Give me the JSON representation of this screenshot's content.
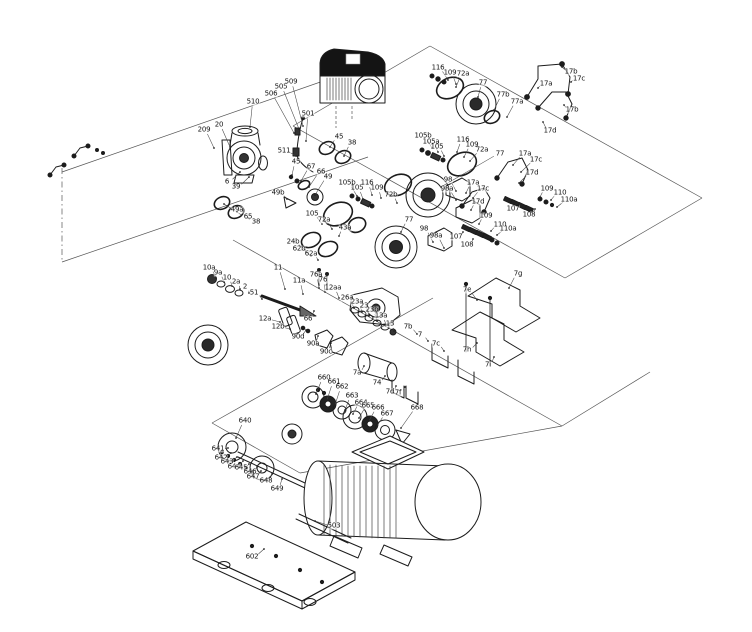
{
  "diagram": {
    "figure_type": "exploded-parts-diagram",
    "subject": "multistage pump with drive, shaft seals, coupling, guards, motor and base plate",
    "background_color": "#ffffff",
    "line_color": "#1c1c1c",
    "guide_line_color": "#555555",
    "label_color": "#111111"
  },
  "parts": [
    {
      "t": "209",
      "x": 204,
      "y": 130,
      "tx": 214,
      "ty": 148
    },
    {
      "t": "20",
      "x": 219,
      "y": 125,
      "tx": 230,
      "ty": 147
    },
    {
      "t": "510",
      "x": 253,
      "y": 102,
      "tx": 250,
      "ty": 127
    },
    {
      "t": "506",
      "x": 271,
      "y": 94,
      "tx": 294,
      "ty": 133
    },
    {
      "t": "505",
      "x": 281,
      "y": 87,
      "tx": 299,
      "ty": 129
    },
    {
      "t": "509",
      "x": 291,
      "y": 82,
      "tx": 303,
      "ty": 126
    },
    {
      "t": "501",
      "x": 308,
      "y": 114,
      "tx": 306,
      "ty": 141
    },
    {
      "t": "511",
      "x": 284,
      "y": 151,
      "tx": 296,
      "ty": 156
    },
    {
      "t": "6",
      "x": 227,
      "y": 182,
      "tx": 240,
      "ty": 172
    },
    {
      "t": "39",
      "x": 236,
      "y": 187,
      "tx": 249,
      "ty": 177
    },
    {
      "t": "49a",
      "x": 237,
      "y": 210,
      "tx": 224,
      "ty": 204
    },
    {
      "t": "65",
      "x": 248,
      "y": 217,
      "tx": 237,
      "ty": 212
    },
    {
      "t": "38",
      "x": 256,
      "y": 222,
      "tx": 248,
      "ty": 218
    },
    {
      "t": "45",
      "x": 296,
      "y": 162,
      "tx": 292,
      "ty": 175
    },
    {
      "t": "67",
      "x": 311,
      "y": 167,
      "tx": 301,
      "ty": 181
    },
    {
      "t": "66",
      "x": 321,
      "y": 172,
      "tx": 309,
      "ty": 187
    },
    {
      "t": "49",
      "x": 328,
      "y": 177,
      "tx": 315,
      "ty": 195
    },
    {
      "t": "49b",
      "x": 278,
      "y": 193,
      "tx": 287,
      "ty": 199
    },
    {
      "t": "45",
      "x": 339,
      "y": 137,
      "tx": 330,
      "ty": 147
    },
    {
      "t": "38",
      "x": 352,
      "y": 143,
      "tx": 344,
      "ty": 156
    },
    {
      "t": "105b",
      "x": 347,
      "y": 183,
      "tx": 357,
      "ty": 196
    },
    {
      "t": "105",
      "x": 357,
      "y": 188,
      "tx": 363,
      "ty": 199
    },
    {
      "t": "116",
      "x": 367,
      "y": 183,
      "tx": 372,
      "ty": 195
    },
    {
      "t": "109",
      "x": 377,
      "y": 188,
      "tx": 381,
      "ty": 198
    },
    {
      "t": "72b",
      "x": 391,
      "y": 195,
      "tx": 397,
      "ty": 203
    },
    {
      "t": "77",
      "x": 409,
      "y": 220,
      "tx": 401,
      "ty": 232
    },
    {
      "t": "98",
      "x": 424,
      "y": 229,
      "tx": 433,
      "ty": 242
    },
    {
      "t": "98a",
      "x": 436,
      "y": 236,
      "tx": 444,
      "ty": 248
    },
    {
      "t": "105",
      "x": 312,
      "y": 214,
      "tx": 322,
      "ty": 224
    },
    {
      "t": "72a",
      "x": 324,
      "y": 220,
      "tx": 332,
      "ty": 229
    },
    {
      "t": "43a",
      "x": 345,
      "y": 228,
      "tx": 339,
      "ty": 236
    },
    {
      "t": "24b",
      "x": 293,
      "y": 242,
      "tx": 305,
      "ty": 250
    },
    {
      "t": "62b",
      "x": 299,
      "y": 249,
      "tx": 311,
      "ty": 256
    },
    {
      "t": "62a",
      "x": 311,
      "y": 254,
      "tx": 318,
      "ty": 260
    },
    {
      "t": "10a",
      "x": 209,
      "y": 268,
      "tx": 216,
      "ty": 278
    },
    {
      "t": "9a",
      "x": 218,
      "y": 273,
      "tx": 224,
      "ty": 282
    },
    {
      "t": "10",
      "x": 227,
      "y": 278,
      "tx": 232,
      "ty": 286
    },
    {
      "t": "2a",
      "x": 236,
      "y": 282,
      "tx": 240,
      "ty": 289
    },
    {
      "t": "2",
      "x": 245,
      "y": 287,
      "tx": 249,
      "ty": 293
    },
    {
      "t": "51",
      "x": 254,
      "y": 293,
      "tx": 262,
      "ty": 299
    },
    {
      "t": "11",
      "x": 278,
      "y": 268,
      "tx": 285,
      "ty": 289
    },
    {
      "t": "11a",
      "x": 299,
      "y": 281,
      "tx": 303,
      "ty": 294
    },
    {
      "t": "76a",
      "x": 316,
      "y": 275,
      "tx": 319,
      "ty": 288
    },
    {
      "t": "76",
      "x": 323,
      "y": 280,
      "tx": 325,
      "ty": 292
    },
    {
      "t": "12aa",
      "x": 333,
      "y": 288,
      "tx": 339,
      "ty": 298
    },
    {
      "t": "66",
      "x": 308,
      "y": 319,
      "tx": 314,
      "ty": 311
    },
    {
      "t": "12a",
      "x": 265,
      "y": 319,
      "tx": 280,
      "ty": 322
    },
    {
      "t": "12b",
      "x": 278,
      "y": 327,
      "tx": 290,
      "ty": 329
    },
    {
      "t": "26a",
      "x": 347,
      "y": 298,
      "tx": 354,
      "ty": 308
    },
    {
      "t": "23a",
      "x": 357,
      "y": 302,
      "tx": 362,
      "ty": 312
    },
    {
      "t": "23",
      "x": 364,
      "y": 306,
      "tx": 369,
      "ty": 316
    },
    {
      "t": "23b",
      "x": 372,
      "y": 310,
      "tx": 377,
      "ty": 321
    },
    {
      "t": "13a",
      "x": 381,
      "y": 316,
      "tx": 386,
      "ty": 325
    },
    {
      "t": "13",
      "x": 390,
      "y": 324,
      "tx": 394,
      "ty": 331
    },
    {
      "t": "90d",
      "x": 298,
      "y": 337,
      "tx": 306,
      "ty": 330
    },
    {
      "t": "90a",
      "x": 313,
      "y": 344,
      "tx": 318,
      "ty": 336
    },
    {
      "t": "90c",
      "x": 326,
      "y": 352,
      "tx": 331,
      "ty": 343
    },
    {
      "t": "7a",
      "x": 357,
      "y": 373,
      "tx": 364,
      "ty": 366
    },
    {
      "t": "74",
      "x": 377,
      "y": 383,
      "tx": 385,
      "ty": 376
    },
    {
      "t": "7d",
      "x": 390,
      "y": 392,
      "tx": 396,
      "ty": 386
    },
    {
      "t": "7f",
      "x": 398,
      "y": 393,
      "tx": 405,
      "ty": 387
    },
    {
      "t": "7b",
      "x": 408,
      "y": 327,
      "tx": 417,
      "ty": 334
    },
    {
      "t": "7",
      "x": 420,
      "y": 335,
      "tx": 428,
      "ty": 341
    },
    {
      "t": "7c",
      "x": 436,
      "y": 344,
      "tx": 444,
      "ty": 351
    },
    {
      "t": "7g",
      "x": 518,
      "y": 274,
      "tx": 509,
      "ty": 288
    },
    {
      "t": "7e",
      "x": 467,
      "y": 290,
      "tx": 477,
      "ty": 300
    },
    {
      "t": "7h",
      "x": 467,
      "y": 350,
      "tx": 477,
      "ty": 343
    },
    {
      "t": "7i",
      "x": 488,
      "y": 365,
      "tx": 494,
      "ty": 357
    },
    {
      "t": "105b",
      "x": 423,
      "y": 136,
      "tx": 432,
      "ty": 148
    },
    {
      "t": "105a",
      "x": 431,
      "y": 142,
      "tx": 438,
      "ty": 152
    },
    {
      "t": "105",
      "x": 437,
      "y": 147,
      "tx": 444,
      "ty": 156
    },
    {
      "t": "116",
      "x": 463,
      "y": 140,
      "tx": 457,
      "ty": 152
    },
    {
      "t": "109",
      "x": 472,
      "y": 145,
      "tx": 464,
      "ty": 157
    },
    {
      "t": "72a",
      "x": 482,
      "y": 150,
      "tx": 470,
      "ty": 161
    },
    {
      "t": "77",
      "x": 500,
      "y": 154,
      "tx": 441,
      "ty": 187
    },
    {
      "t": "17a",
      "x": 525,
      "y": 154,
      "tx": 513,
      "ty": 165
    },
    {
      "t": "17c",
      "x": 536,
      "y": 160,
      "tx": 521,
      "ty": 172
    },
    {
      "t": "17d",
      "x": 532,
      "y": 173,
      "tx": 519,
      "ty": 183
    },
    {
      "t": "17a",
      "x": 473,
      "y": 183,
      "tx": 466,
      "ty": 193
    },
    {
      "t": "17c",
      "x": 483,
      "y": 189,
      "tx": 473,
      "ty": 198
    },
    {
      "t": "17d",
      "x": 478,
      "y": 202,
      "tx": 471,
      "ty": 210
    },
    {
      "t": "98",
      "x": 448,
      "y": 180,
      "tx": 456,
      "ty": 191
    },
    {
      "t": "98a",
      "x": 447,
      "y": 189,
      "tx": 456,
      "ty": 200
    },
    {
      "t": "116",
      "x": 438,
      "y": 68,
      "tx": 448,
      "ty": 80
    },
    {
      "t": "109",
      "x": 450,
      "y": 73,
      "tx": 456,
      "ty": 84
    },
    {
      "t": "72a",
      "x": 463,
      "y": 74,
      "tx": 456,
      "ty": 87
    },
    {
      "t": "77",
      "x": 483,
      "y": 83,
      "tx": 478,
      "ty": 97
    },
    {
      "t": "77b",
      "x": 503,
      "y": 95,
      "tx": 494,
      "ty": 110
    },
    {
      "t": "77a",
      "x": 517,
      "y": 102,
      "tx": 507,
      "ty": 117
    },
    {
      "t": "17b",
      "x": 571,
      "y": 72,
      "tx": 562,
      "ty": 67
    },
    {
      "t": "17c",
      "x": 579,
      "y": 79,
      "tx": 571,
      "ty": 82
    },
    {
      "t": "17a",
      "x": 546,
      "y": 84,
      "tx": 538,
      "ty": 88
    },
    {
      "t": "17b",
      "x": 572,
      "y": 110,
      "tx": 564,
      "ty": 105
    },
    {
      "t": "17d",
      "x": 550,
      "y": 131,
      "tx": 543,
      "ty": 122
    },
    {
      "t": "109",
      "x": 547,
      "y": 189,
      "tx": 540,
      "ty": 197
    },
    {
      "t": "110",
      "x": 560,
      "y": 193,
      "tx": 551,
      "ty": 200
    },
    {
      "t": "110a",
      "x": 569,
      "y": 200,
      "tx": 557,
      "ty": 207
    },
    {
      "t": "107",
      "x": 513,
      "y": 209,
      "tx": 520,
      "ty": 204
    },
    {
      "t": "108",
      "x": 529,
      "y": 215,
      "tx": 535,
      "ty": 209
    },
    {
      "t": "109",
      "x": 486,
      "y": 216,
      "tx": 479,
      "ty": 224
    },
    {
      "t": "110",
      "x": 500,
      "y": 225,
      "tx": 491,
      "ty": 231
    },
    {
      "t": "110a",
      "x": 508,
      "y": 229,
      "tx": 497,
      "ty": 235
    },
    {
      "t": "107",
      "x": 456,
      "y": 237,
      "tx": 463,
      "ty": 232
    },
    {
      "t": "108",
      "x": 467,
      "y": 245,
      "tx": 473,
      "ty": 239
    },
    {
      "t": "660",
      "x": 324,
      "y": 378,
      "tx": 316,
      "ty": 394
    },
    {
      "t": "661",
      "x": 334,
      "y": 382,
      "tx": 327,
      "ty": 400
    },
    {
      "t": "662",
      "x": 342,
      "y": 387,
      "tx": 335,
      "ty": 405
    },
    {
      "t": "663",
      "x": 352,
      "y": 396,
      "tx": 345,
      "ty": 410
    },
    {
      "t": "664",
      "x": 361,
      "y": 403,
      "tx": 353,
      "ty": 414
    },
    {
      "t": "665",
      "x": 368,
      "y": 406,
      "tx": 359,
      "ty": 418
    },
    {
      "t": "666",
      "x": 378,
      "y": 408,
      "tx": 369,
      "ty": 421
    },
    {
      "t": "667",
      "x": 387,
      "y": 414,
      "tx": 377,
      "ty": 426
    },
    {
      "t": "668",
      "x": 417,
      "y": 408,
      "tx": 401,
      "ty": 428
    },
    {
      "t": "640",
      "x": 245,
      "y": 421,
      "tx": 236,
      "ty": 438
    },
    {
      "t": "641",
      "x": 218,
      "y": 449,
      "tx": 228,
      "ty": 448
    },
    {
      "t": "642",
      "x": 221,
      "y": 458,
      "tx": 231,
      "ty": 453
    },
    {
      "t": "643",
      "x": 227,
      "y": 462,
      "tx": 237,
      "ty": 457
    },
    {
      "t": "644",
      "x": 234,
      "y": 467,
      "tx": 243,
      "ty": 461
    },
    {
      "t": "645",
      "x": 241,
      "y": 468,
      "tx": 249,
      "ty": 464
    },
    {
      "t": "646",
      "x": 250,
      "y": 472,
      "tx": 257,
      "ty": 467
    },
    {
      "t": "647",
      "x": 253,
      "y": 477,
      "tx": 261,
      "ty": 471
    },
    {
      "t": "648",
      "x": 266,
      "y": 481,
      "tx": 272,
      "ty": 474
    },
    {
      "t": "649",
      "x": 277,
      "y": 489,
      "tx": 282,
      "ty": 479
    },
    {
      "t": "503",
      "x": 334,
      "y": 526,
      "tx": 315,
      "ty": 521
    },
    {
      "t": "602",
      "x": 252,
      "y": 557,
      "tx": 264,
      "ty": 549
    }
  ]
}
